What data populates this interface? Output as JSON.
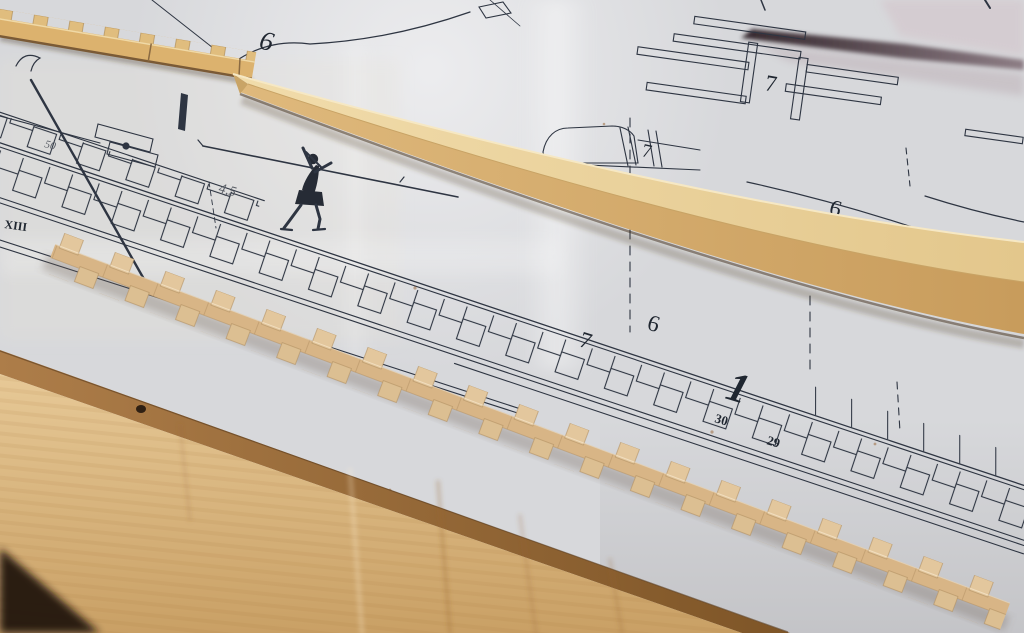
{
  "labels": {
    "six_top": "6",
    "seven_frame": "7",
    "seven_shoe": "7",
    "six_right": "6",
    "seven_band": "7",
    "six_band": "6",
    "one_band": "1",
    "thirty": "30",
    "twentynine": "29",
    "xiii": "XIII",
    "scale_45": "4,5",
    "scale_50": "50"
  },
  "colors": {
    "paper": "#d7d8db",
    "ink": "#2e3542",
    "wood_strip_top": "#efd9a8",
    "wood_strip_front": "#d9b272",
    "wood_blocks": "#e2c69c",
    "board_face": "#e0c18d",
    "board_edge": "#9c6e3e",
    "table_dark": "#2b1a10",
    "shadow_wedge": "#4a3a42"
  }
}
